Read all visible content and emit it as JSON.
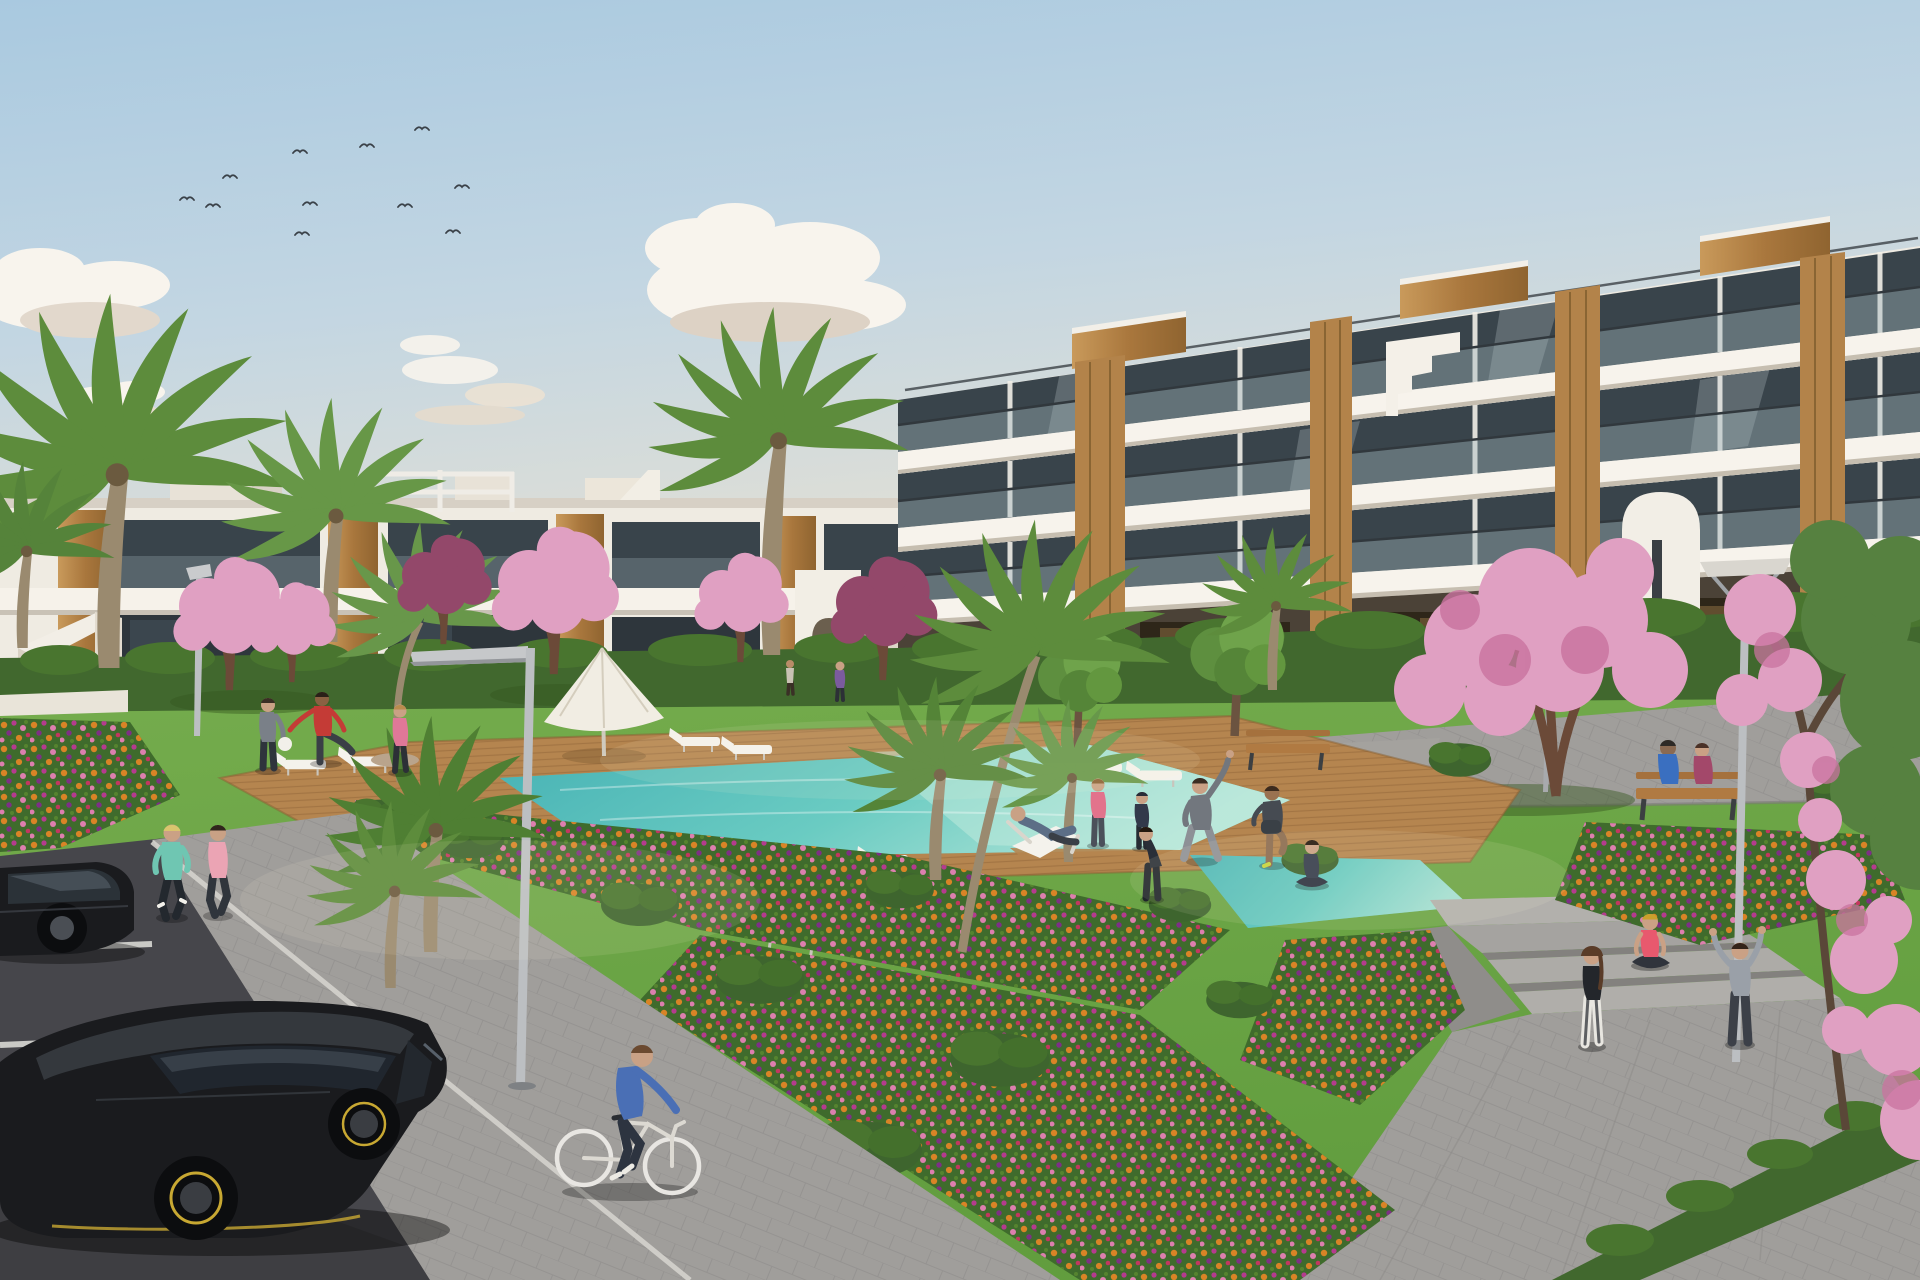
{
  "scene": {
    "type": "architectural-3d-rendering",
    "setting": "modern white apartment complex with communal pool garden",
    "time": "sunny day, light haze",
    "counts": {
      "birds": 11,
      "cloud_groups": 4,
      "buildings": 2,
      "right_building_floors": 3,
      "left_building_floors": 2,
      "palm_trees": 9,
      "blossom_trees": 8,
      "sun_loungers": 8,
      "umbrellas": 1,
      "benches": 2,
      "street_lamps": 4,
      "people": 20,
      "cars": 2,
      "bicycles": 1,
      "pools": 2
    }
  },
  "colors": {
    "sky_top": "#a9c9e0",
    "sky_horizon": "#ece3d2",
    "cloud_white": "#f8f4ed",
    "facade_white": "#efebe2",
    "facade_shade": "#d9d2c6",
    "slab_white": "#f7f3ec",
    "glass_dark": "#39444b",
    "wood_panel": "#b3834a",
    "hedge_green": "#41682e",
    "lawn_green": "#6da646",
    "lawn_shadow": "#35571f",
    "pool_turquoise": "#4fbdb7",
    "pool_shallow": "#c3ebdd",
    "deck_wood": "#b5854f",
    "paver_gray": "#a09e9b",
    "road_asphalt": "#46464b",
    "flower_base_green": "#3f6b2c",
    "flower_orange": "#d98426",
    "flower_magenta": "#b53b8e",
    "flower_pink": "#dd7fae",
    "blossom_pink": "#e0a0c2",
    "blossom_maroon": "#93486a",
    "palm_green": "#5d8c3c",
    "trunk_brown": "#8a7a62",
    "car_black": "#1a1b1e",
    "car_accent_yellow": "#c8a832",
    "lamp_gray": "#bcbfc2",
    "skin": "#c9a185",
    "white_furniture": "#f4f2ec"
  }
}
